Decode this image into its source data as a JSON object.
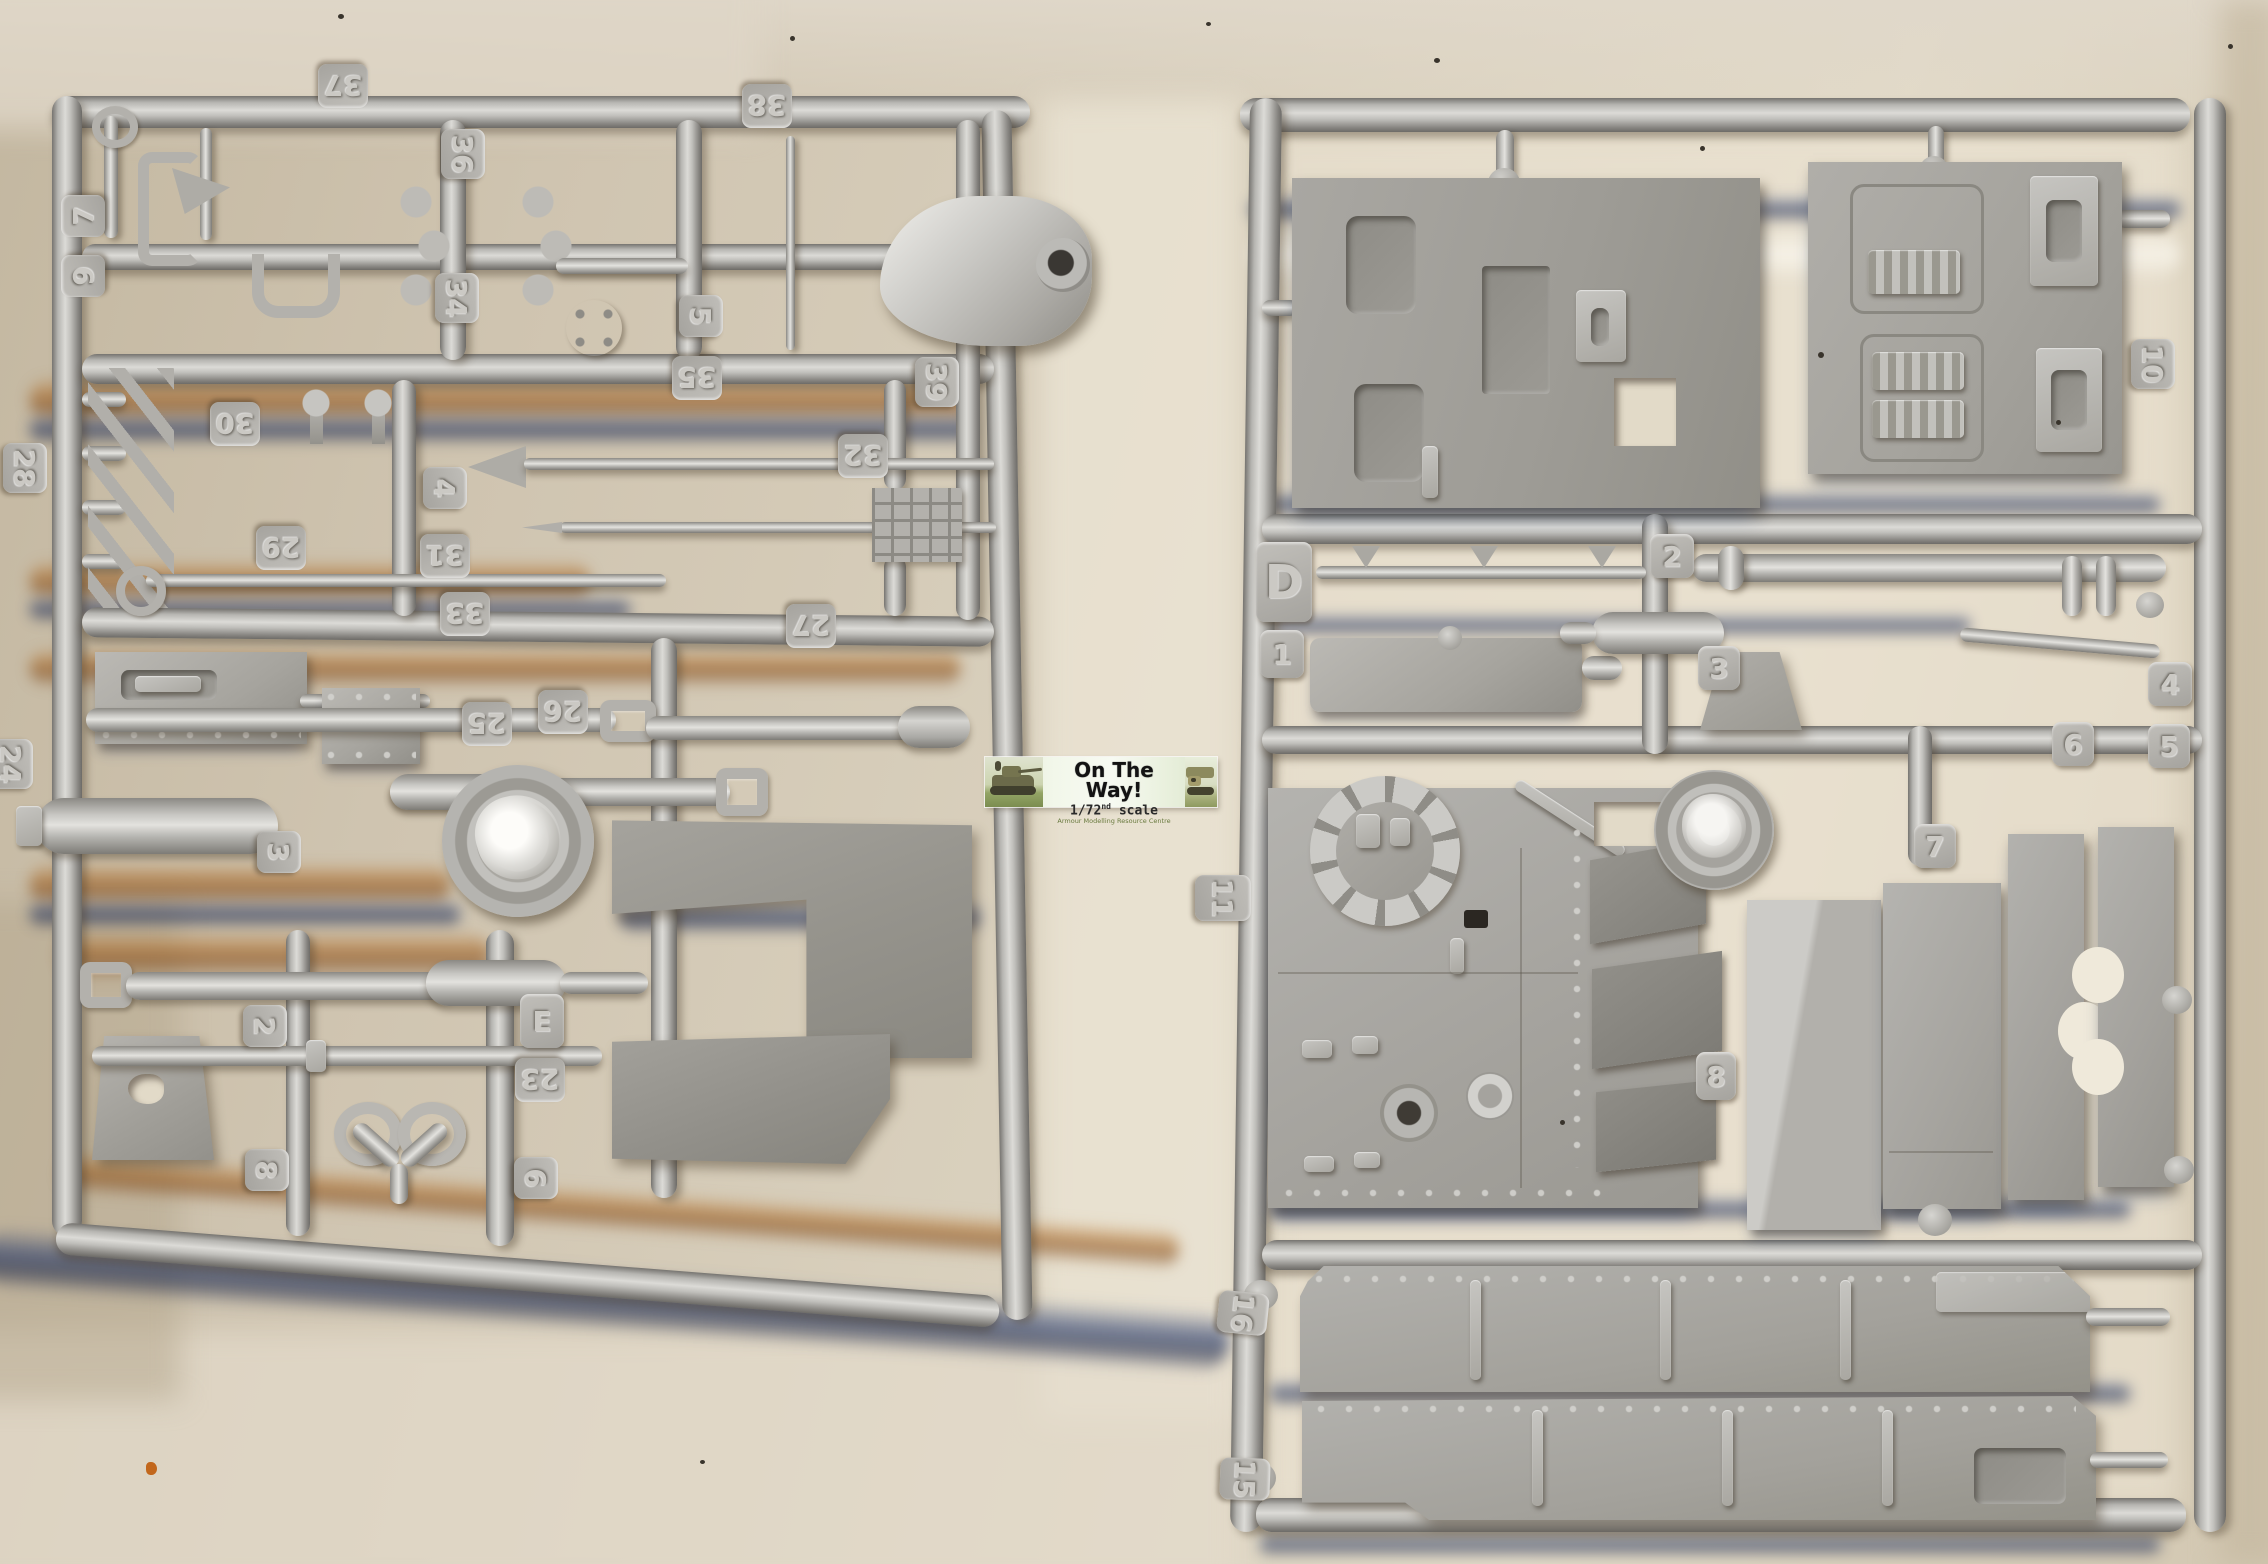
{
  "watermark": {
    "title": "On The Way!",
    "scale_value": "1/72",
    "scale_superscript": "nd",
    "scale_unit": "scale",
    "credit": "Armour Modelling Resource Centre"
  },
  "sprues": {
    "left": {
      "tags": [
        {
          "label": "37"
        },
        {
          "label": "38"
        },
        {
          "label": "36"
        },
        {
          "label": "7"
        },
        {
          "label": "9"
        },
        {
          "label": "34"
        },
        {
          "label": "5"
        },
        {
          "label": "35"
        },
        {
          "label": "30"
        },
        {
          "label": "4"
        },
        {
          "label": "29"
        },
        {
          "label": "31"
        },
        {
          "label": "33"
        },
        {
          "label": "39"
        },
        {
          "label": "32"
        },
        {
          "label": "27"
        },
        {
          "label": "26"
        },
        {
          "label": "25"
        },
        {
          "label": "28"
        },
        {
          "label": "24"
        },
        {
          "label": "3"
        },
        {
          "label": "2"
        },
        {
          "label": "E"
        },
        {
          "label": "23"
        },
        {
          "label": "8"
        },
        {
          "label": "6"
        }
      ]
    },
    "right": {
      "tags": [
        {
          "label": "D"
        },
        {
          "label": "2"
        },
        {
          "label": "1"
        },
        {
          "label": "3"
        },
        {
          "label": "10"
        },
        {
          "label": "4"
        },
        {
          "label": "6"
        },
        {
          "label": "5"
        },
        {
          "label": "7"
        },
        {
          "label": "11"
        },
        {
          "label": "8"
        },
        {
          "label": "16"
        },
        {
          "label": "15"
        }
      ]
    }
  },
  "colors": {
    "background": "#d8cfbd",
    "plastic_light": "#c8c7c3",
    "plastic_mid": "#b3b1ac",
    "panel_gray": "#9b9992",
    "streak_orange": "#a5671f",
    "streak_blue": "#1d3260",
    "banner_background": "#eef4e4",
    "banner_text": "#131313",
    "credit_green": "#697a3f"
  }
}
